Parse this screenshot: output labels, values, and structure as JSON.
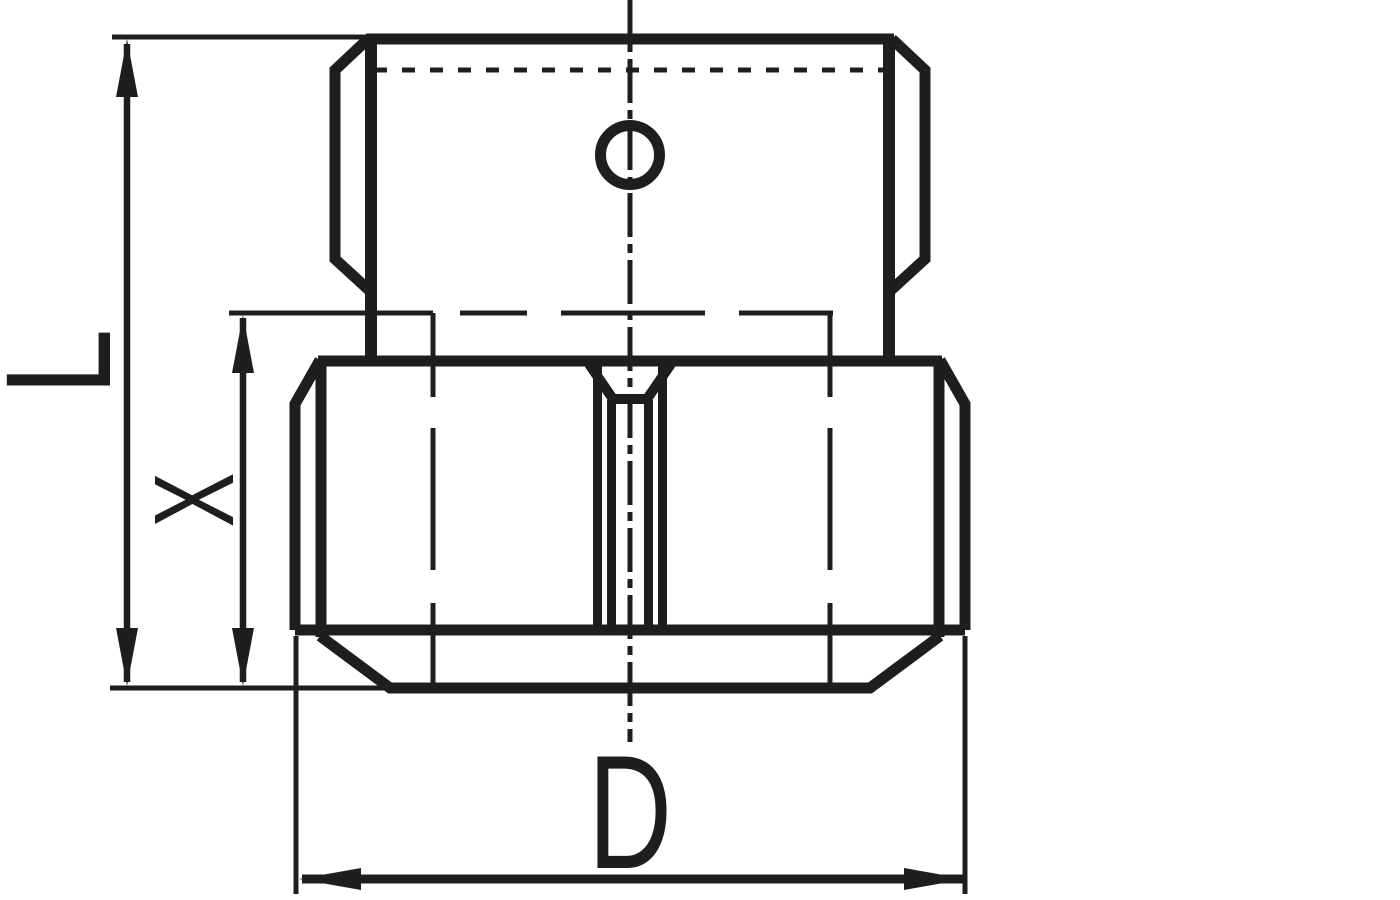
{
  "labels": {
    "L": "L",
    "X": "X",
    "D": "D"
  },
  "colors": {
    "line": "#201d1e",
    "background": "#ffffff"
  }
}
